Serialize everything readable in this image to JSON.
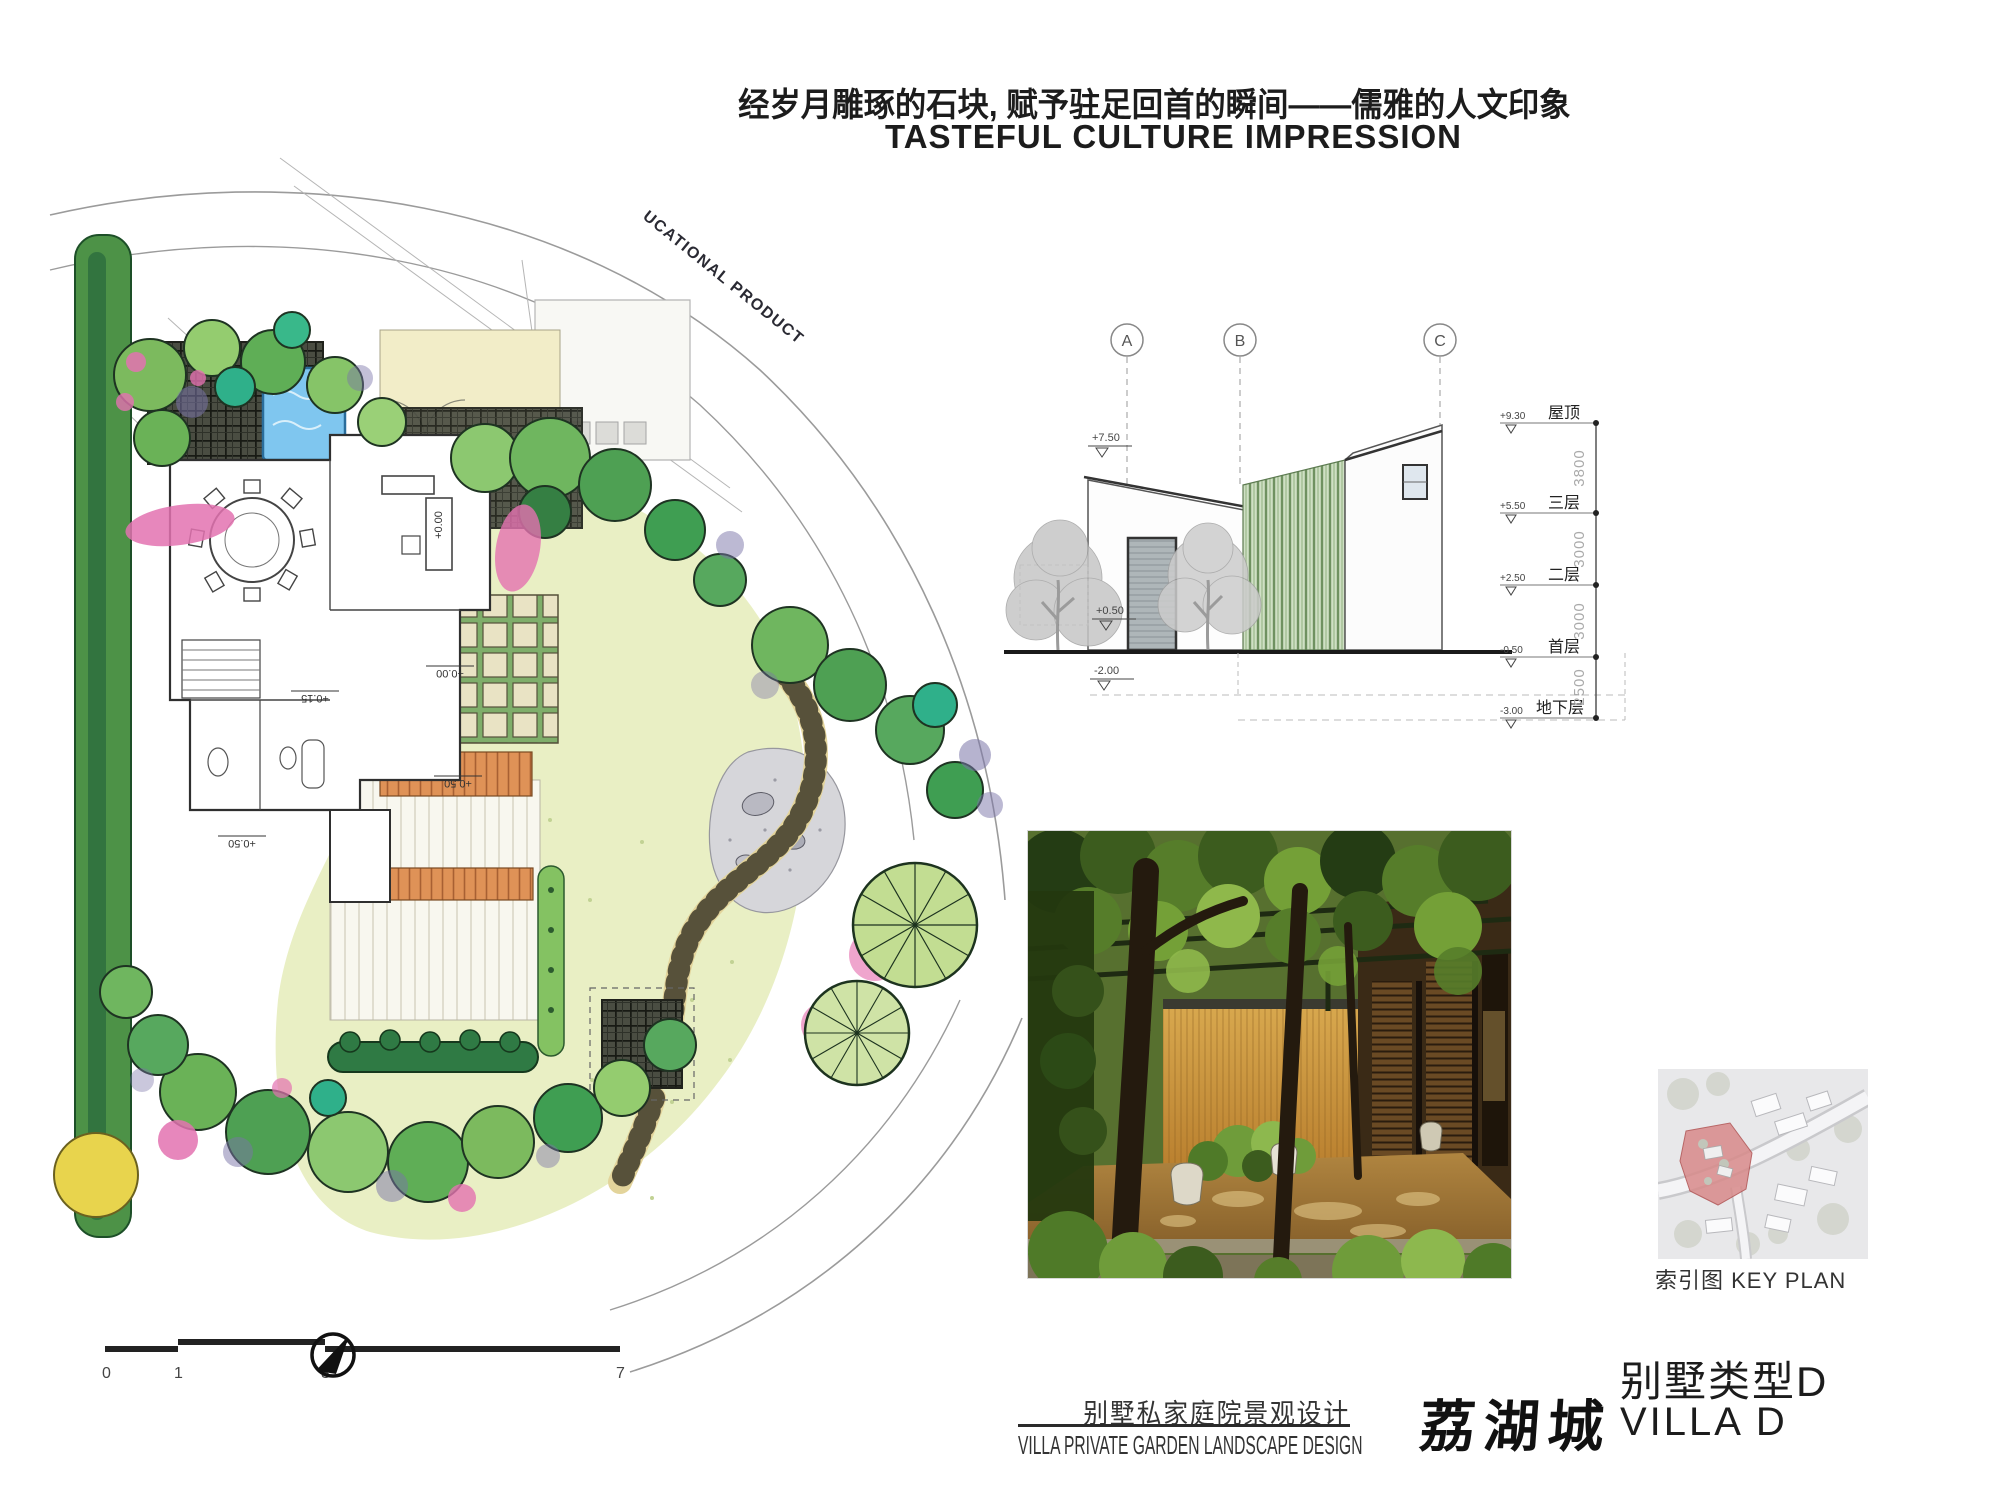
{
  "header": {
    "title_zh": "经岁月雕琢的石块, 赋予驻足回首的瞬间——儒雅的人文印象",
    "title_en": "TASTEFUL CULTURE IMPRESSION"
  },
  "plan": {
    "road_label": "UCATIONAL PRODUCT",
    "annotations": {
      "a1": "+0.15",
      "a2": "+0.00",
      "a3": "+0.50",
      "a4": "+0.50",
      "a5": "+0.00"
    },
    "scale_ticks": {
      "t0": "0",
      "t1": "1",
      "t2": "3",
      "t3": "7"
    }
  },
  "elevation": {
    "grids": {
      "a": "A",
      "b": "B",
      "c": "C"
    },
    "marks": {
      "m1": "+7.50",
      "m2": "+0.50",
      "m3": "-2.00"
    },
    "floors": {
      "f1": {
        "v": "+9.30",
        "n": "屋顶"
      },
      "f2": {
        "v": "+5.50",
        "n": "三层"
      },
      "f3": {
        "v": "+2.50",
        "n": "二层"
      },
      "f4": {
        "v": "-0.50",
        "n": "首层"
      },
      "f5": {
        "v": "-3.00",
        "n": "地下层"
      }
    },
    "dims": {
      "d1": "3800",
      "d2": "3000",
      "d3": "3000",
      "d4": "2500"
    }
  },
  "key_plan": {
    "label": "索引图  KEY PLAN"
  },
  "footer": {
    "subtitle_zh": "别墅私家庭院景观设计",
    "subtitle_en": "VILLA  PRIVATE GARDEN LANDSCAPE DESIGN",
    "logo": "荔湖城",
    "type_zh": "别墅类型D",
    "type_en": "VILLA  D"
  },
  "colors": {
    "accent_red": "#d88a8a",
    "pool_blue": "#7fc6ef",
    "leaf_green": "#6ab257",
    "ink": "#2a2a2a"
  }
}
